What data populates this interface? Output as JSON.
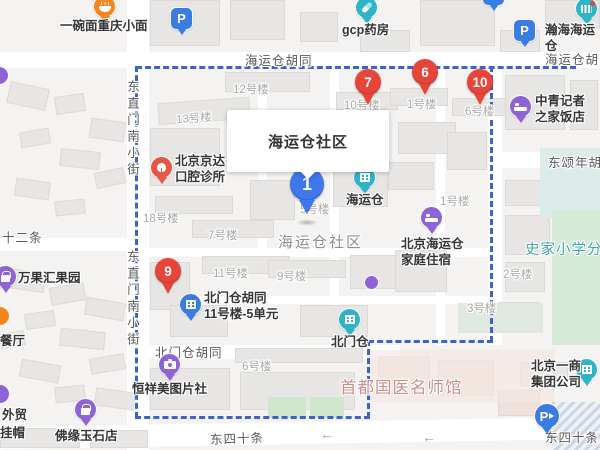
{
  "info_window": {
    "title": "海运仓社区"
  },
  "selected_marker": {
    "number": "1"
  },
  "result_markers": [
    {
      "number": "7"
    },
    {
      "number": "6"
    },
    {
      "number": "10"
    },
    {
      "number": "9"
    }
  ],
  "streets": [
    "海运仓胡同",
    "海运仓胡同",
    "东直门南小街",
    "东直门南小街",
    "十二条",
    "北门仓胡同",
    "东四十条",
    "东四十条",
    "东颂年胡同"
  ],
  "areas": {
    "community": "海运仓社区",
    "medical_hall": "首都国医名师馆",
    "school": "史家小学分校"
  },
  "building_labels": [
    "12号楼",
    "13号楼",
    "18号楼",
    "7号楼",
    "11号楼",
    "9号楼",
    "6号楼",
    "10号楼",
    "1号楼",
    "6号楼",
    "1号楼",
    "2号楼",
    "3号楼",
    "5号楼"
  ],
  "pois": [
    {
      "label": "一碗面重庆小面",
      "icon": "noodles-icon",
      "color": "#f5861f"
    },
    {
      "label": "gcp药房",
      "icon": "pharmacy-icon",
      "color": "#2fb3c6"
    },
    {
      "label": "瀚海海运仓",
      "icon": "landmark-icon",
      "color": "#2fb3c6"
    },
    {
      "label": "中青记者\n之家饭店",
      "icon": "hotel-bed-icon",
      "color": "#8d63d6"
    },
    {
      "label": "北京京达\n口腔诊所",
      "icon": "dental-icon",
      "color": "#e8564a"
    },
    {
      "label": "海运仓",
      "icon": "building-icon",
      "color": "#2fb3c6"
    },
    {
      "label": "北京海运仓\n家庭住宿",
      "icon": "hotel-bed-icon",
      "color": "#8d63d6"
    },
    {
      "label": "北门仓胡同\n11号楼-5单元",
      "icon": "building-icon",
      "color": "#3b7ce2"
    },
    {
      "label": "北门仓",
      "icon": "building-icon",
      "color": "#2fb3c6"
    },
    {
      "label": "恒祥美图片社",
      "icon": "camera-icon",
      "color": "#8d63d6"
    },
    {
      "label": "佛缘玉石店",
      "icon": "shop-bag-icon",
      "color": "#8d63d6"
    },
    {
      "label": "万果汇果园",
      "icon": "shop-bag-icon",
      "color": "#8d63d6"
    },
    {
      "label": "北京一商\n集团公司",
      "icon": "building-icon",
      "color": "#2fb3c6"
    },
    {
      "label": "P",
      "icon": "parking-icon",
      "color": "#3b7ce2"
    },
    {
      "label": "P",
      "icon": "parking-icon",
      "color": "#3b7ce2"
    },
    {
      "label": "P",
      "icon": "parking-entrance-icon",
      "color": "#3b7ce2"
    }
  ],
  "partial_labels": [
    "餐厅",
    "外贸",
    "挂帽"
  ],
  "glyphs": {
    "left_arrow": "←"
  },
  "colors": {
    "background": "#f4f3f1",
    "road": "#ffffff",
    "boundary": "#3c63cc",
    "marker_red": "#e8453a",
    "marker_selected_blue": "#3e78ec",
    "poi_teal": "#2fb3c6",
    "poi_purple": "#8d63d6",
    "poi_orange": "#f5861f",
    "poi_blue": "#3b7ce2",
    "poi_red": "#e8564a",
    "green_area": "#cfe7cc",
    "school_green": "#d6ead8",
    "area_text_pink": "#cd8d8d",
    "school_text_teal": "#3fa8a3"
  }
}
